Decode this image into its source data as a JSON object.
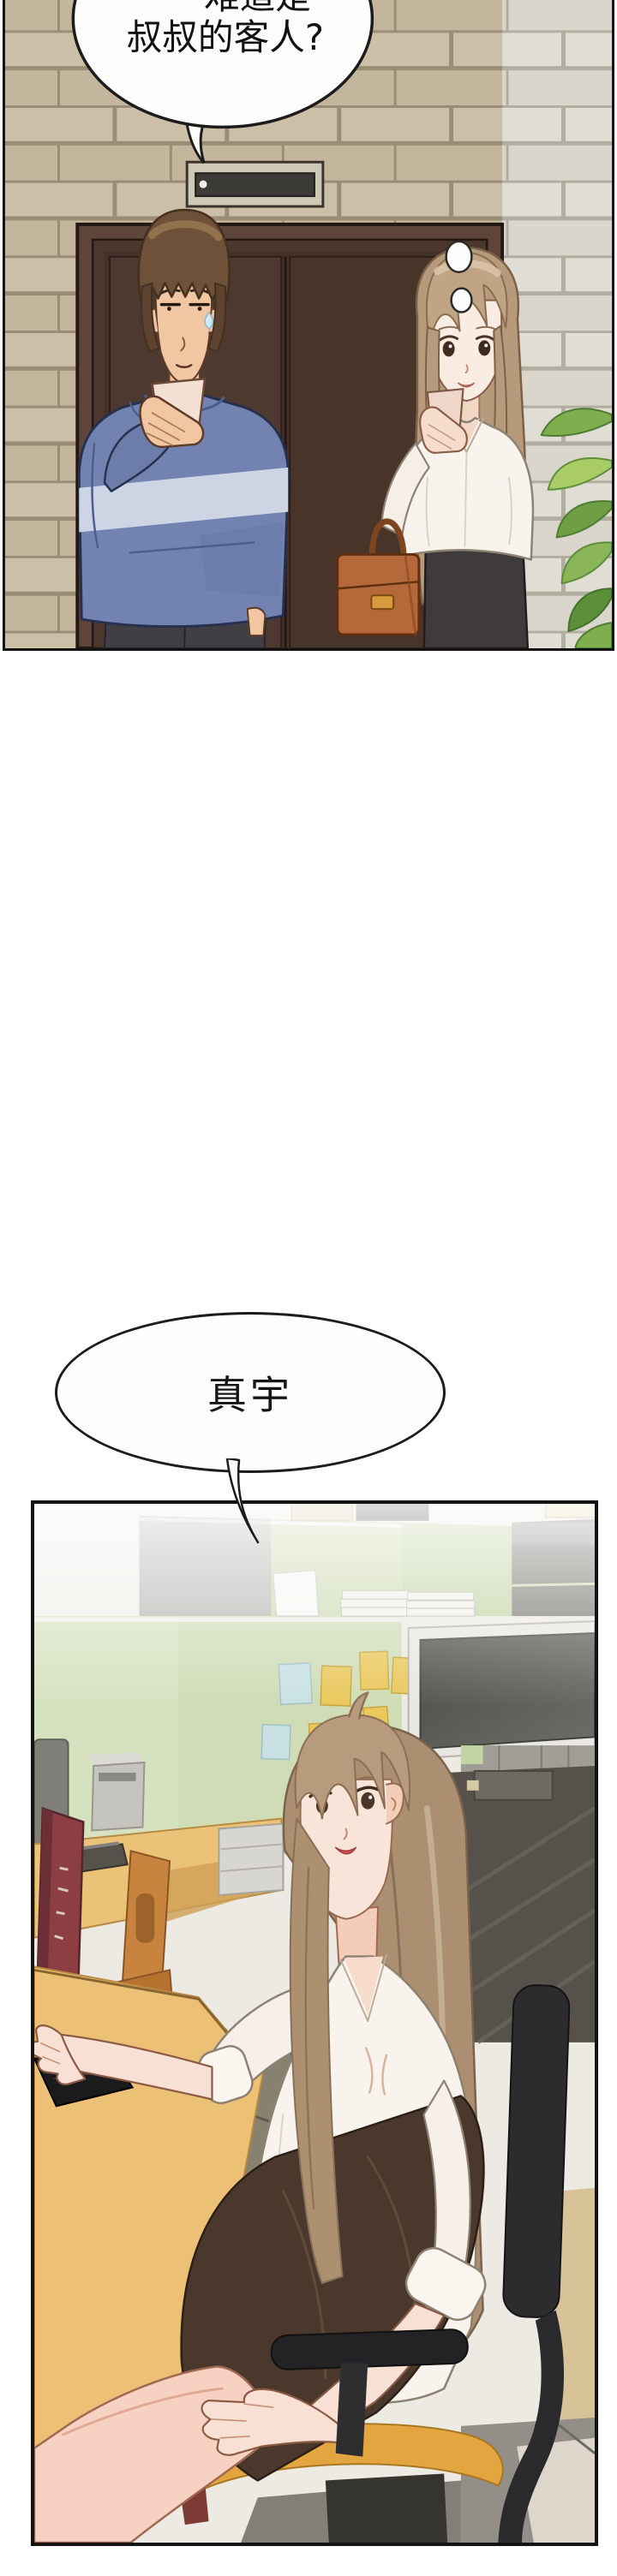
{
  "speech": {
    "top_bubble": {
      "line1": "难道是",
      "line2": "叔叔的客人?"
    },
    "mid_bubble": {
      "text": "真宇"
    }
  },
  "colors": {
    "bubble_fill": "#fdfdfc",
    "bubble_stroke": "#1c1c1c",
    "wall_left": "#c9bba2",
    "wall_right": "#dedbd2",
    "door": "#4e3930",
    "door_frame": "#5f4539",
    "plate_face": "#3c3b37",
    "man_hair": "#6e5138",
    "man_skin": "#f1c7a3",
    "hoodie": "#7383b1",
    "hoodie_stripe": "#cdd4e4",
    "pants": "#413f45",
    "woman_hair": "#b69a7c",
    "woman_skin": "#f9ece2",
    "blouse": "#f8f3ec",
    "skirt_charcoal": "#3f3b3a",
    "bag": "#b5683a",
    "plant_green": "#7fae4e",
    "partition_green": "#cfdcb6",
    "partition_gray": "#b7b5b0",
    "note_yellow": "#e9c85c",
    "note_blue": "#c9e1e4",
    "monitor_screen": "#55554f",
    "desk": "#ecc075",
    "drawer": "#86826f",
    "keyboard": "#1b1b1d",
    "book_red": "#8c3e43",
    "bookend": "#c8833f",
    "office_woman_hair": "#ab8f70",
    "office_woman_skin": "#f9e4d9",
    "skirt_brown": "#4a382c",
    "chair_black": "#2c2b2e",
    "chair_seat": "#e2a53f",
    "floor_gray": "#938f88",
    "floor_tan": "#d8c398",
    "slats": "#56514a"
  }
}
